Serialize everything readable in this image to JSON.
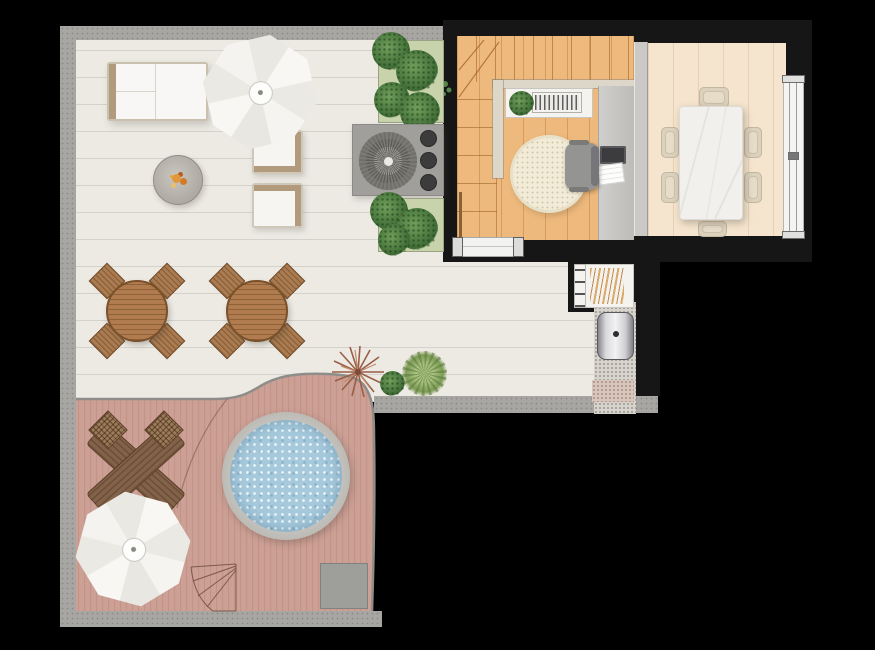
{
  "palette": {
    "background": "#000000",
    "wall": "#161616",
    "parapet": "#a7a6a2",
    "terrace-floor": "#edeae4",
    "deck-wood": "#cda095",
    "deck-plank-line": "#b98a80",
    "water": "#a6cadc",
    "tub-rim": "#b7b5b0",
    "umbrella": "#f6f5f2",
    "sofa-frame": "#b29b7d",
    "bistro-wood": "#b07c4f",
    "dark-wood": "#83624a",
    "planter-bed": "#c9d3ab",
    "plant-green": "#3e6b35",
    "grass-green": "#7d9c55",
    "grill-body": "#a09f9b",
    "indoor-wood": "#eeb97c",
    "dining-floor": "#f5e5ce",
    "marble": "#f1f0ec",
    "chair-beige": "#dbd1bd",
    "rug": "#f2ebd8",
    "railing": "#ddd7ca",
    "desk-gray": "#c7c6c3",
    "speckle": "#d7d3cd",
    "boiler-metal": "#f2f2f4",
    "flame-orange": "#e3973c"
  },
  "scene": {
    "type": "apartment-floor-plan-top-view",
    "areas": [
      {
        "id": "terrace",
        "floor": "tile",
        "items": [
          "outdoor-sofa",
          "parasol",
          "fire-pit-table",
          "lounge-chair",
          "lounge-chair",
          "planter",
          "barbecue-grill",
          "planter",
          "bistro-set",
          "bistro-set",
          "starburst-plant",
          "bush-plant",
          "grass-plant"
        ]
      },
      {
        "id": "deck",
        "floor": "wood-planks",
        "items": [
          "hot-tub",
          "folding-wood-chairs",
          "parasol",
          "step-marks",
          "floor-mat"
        ]
      },
      {
        "id": "stair-room",
        "floor": "oak-planks",
        "items": [
          "staircase",
          "stair-railing",
          "console-shelf",
          "louver-grille",
          "potted-plant",
          "round-rug",
          "desk",
          "office-chair",
          "laptop",
          "papers"
        ]
      },
      {
        "id": "dining-room",
        "floor": "light-planks",
        "items": [
          "marble-dining-table",
          "dining-chair",
          "dining-chair",
          "dining-chair",
          "dining-chair",
          "dining-chair",
          "dining-chair",
          "window"
        ]
      },
      {
        "id": "utility-nook",
        "items": [
          "storage-shelf",
          "firewood",
          "water-heater",
          "gravel-path",
          "sliding-door"
        ]
      }
    ],
    "dining_chair_count": 6,
    "bistro_chair_count": 8
  }
}
